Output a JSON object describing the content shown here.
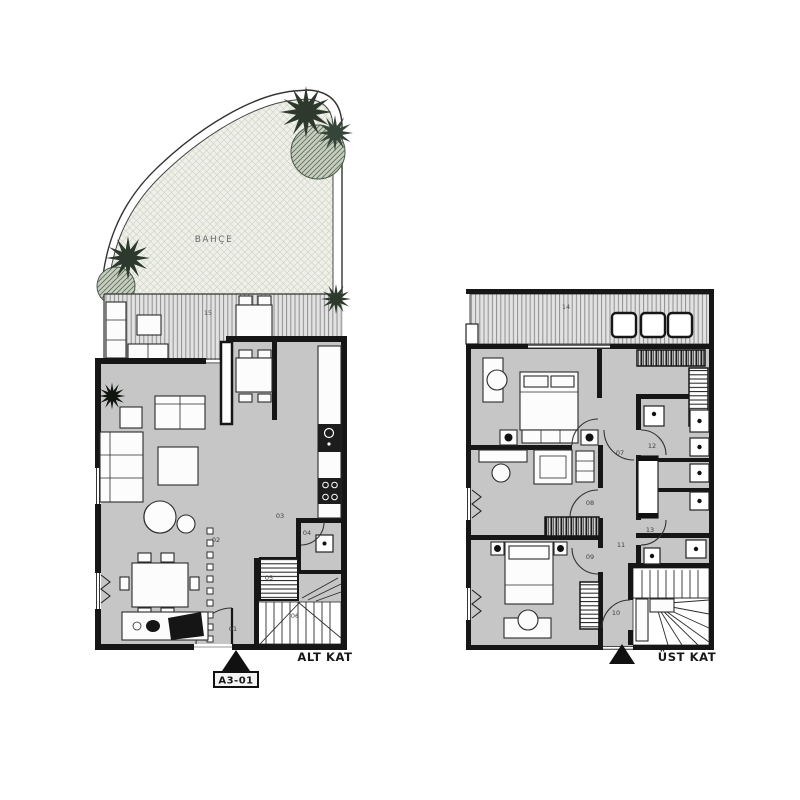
{
  "drawing": {
    "type": "architectural floor plan, two storeys",
    "background": "#ffffff"
  },
  "plans": {
    "lower": {
      "floor_label": "ALT KAT",
      "section_tag": "A3-01",
      "garden_label": "BAHÇE",
      "terrace_label": "15",
      "room_labels": [
        "01",
        "02",
        "03",
        "04",
        "05",
        "06"
      ]
    },
    "upper": {
      "floor_label": "ÜST KAT",
      "terrace_label": "14",
      "room_labels": [
        "07",
        "08",
        "09",
        "10",
        "11",
        "12",
        "13"
      ]
    }
  },
  "colors": {
    "wall": "#161616",
    "floor": "#c6c6c6",
    "terrace_stripe": "#8f8f8f",
    "garden_fill": "#eff0e9",
    "tree_dark": "#2c392c",
    "label_text": "#3f3f3f"
  }
}
